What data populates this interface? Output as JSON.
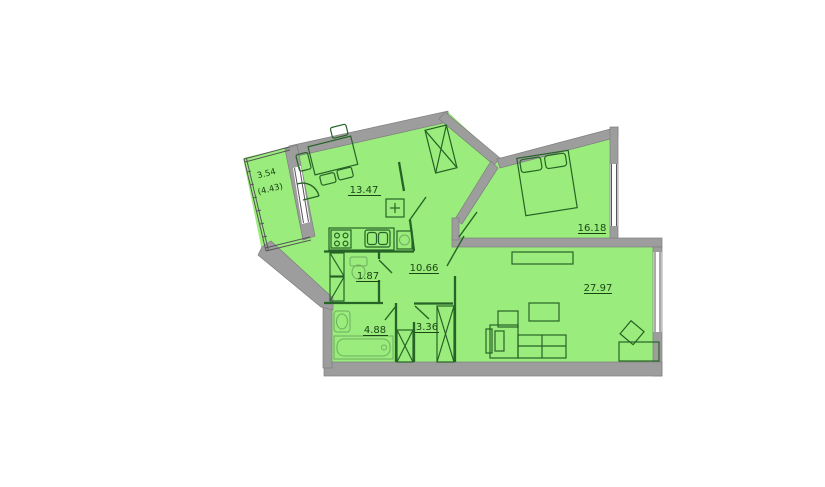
{
  "title": "apartment-floor-plan",
  "colors": {
    "room_fill": "#9AEC7C",
    "wall_gray": "#9D9D9D",
    "outline_green": "#266326",
    "label_color": "#1C4516",
    "background": "#FFFFFF"
  },
  "rooms": {
    "balcony": {
      "area": "3.54",
      "area_alt": "(4.43)"
    },
    "kitchen": {
      "area": "13.47"
    },
    "bedroom": {
      "area": "16.18"
    },
    "hallway": {
      "area": "10.66"
    },
    "wc": {
      "area": "1.87"
    },
    "bathroom": {
      "area": "4.88"
    },
    "storage": {
      "area": "3.36"
    },
    "living_room": {
      "area": "27.97"
    }
  }
}
